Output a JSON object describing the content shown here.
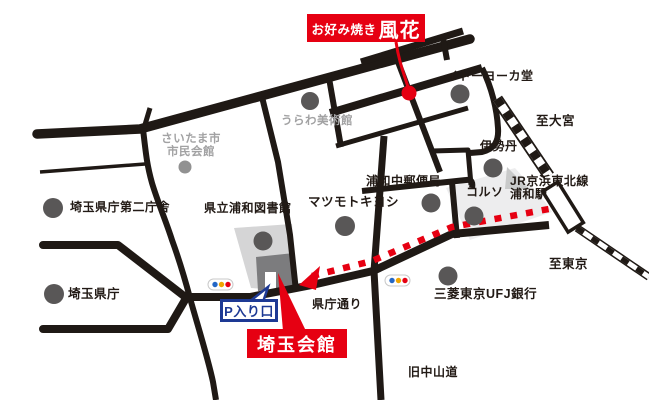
{
  "shop_box": {
    "prefix": "お好み焼き",
    "name": "風花"
  },
  "destination_box": {
    "label": "埼玉会館"
  },
  "parking_box": {
    "label": "P入り口"
  },
  "station": {
    "line": "JR京浜東北線",
    "name": "浦和駅"
  },
  "directions": {
    "to_omiya": "至大宮",
    "to_tokyo": "至東京"
  },
  "streets": {
    "kencho_dori": "県庁通り",
    "kyu_nakasendo": "旧中山道"
  },
  "landmarks": {
    "civic_hall_line1": "さいたま市",
    "civic_hall_line2": "市民会館",
    "urawa_museum": "うらわ美術館",
    "ito_yokado": "イトーヨーカ堂",
    "isetan": "伊勢丹",
    "corso": "コルソ",
    "central_post_office": "浦和中郵便局",
    "matsumoto_kiyoshi": "マツモトキヨシ",
    "prefectural_library": "県立浦和図書館",
    "pref_office_annex": "埼玉県庁第二庁舎",
    "pref_office": "埼玉県庁",
    "ufj_bank": "三菱東京UFJ銀行"
  },
  "colors": {
    "road_black": "#1f1915",
    "accent_red": "#e60012",
    "parking_blue": "#1d3994",
    "signal_blue": "#2467c6",
    "signal_yellow": "#f0a500",
    "signal_red": "#e60012",
    "landmark_gray": "#595757"
  }
}
